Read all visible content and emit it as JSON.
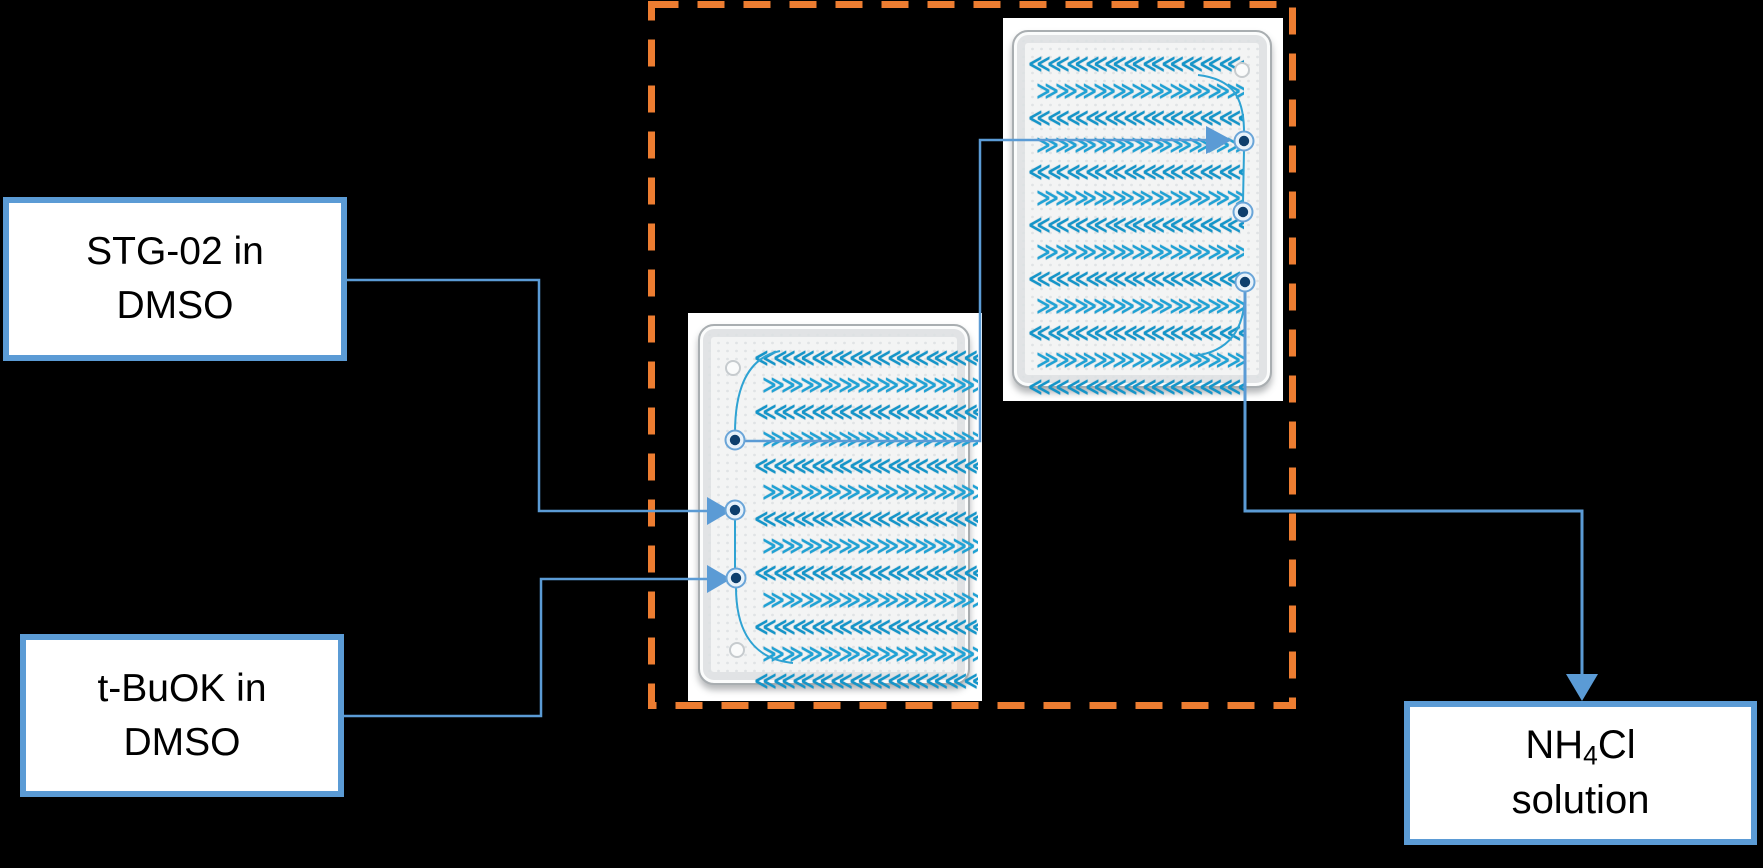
{
  "figure": {
    "background": "#000000",
    "accent_blue": "#5B9BD5",
    "dash_orange": "#ED7D31",
    "channel_blue": "#1495C9",
    "port_navy": "#0E3F6D",
    "box_fill": "#FFFFFF",
    "text_color": "#000000"
  },
  "boxes": {
    "stg02": {
      "line1": "STG-02 in",
      "line2": "DMSO"
    },
    "tbuok": {
      "line1": "t-BuOK in",
      "line2": "DMSO"
    },
    "nh4cl": {
      "line1_pre": "NH",
      "line1_sub": "4",
      "line1_post": "Cl",
      "line2": "solution"
    }
  },
  "icons": {
    "chevron_left": "≪",
    "chevron_right": "≫"
  }
}
